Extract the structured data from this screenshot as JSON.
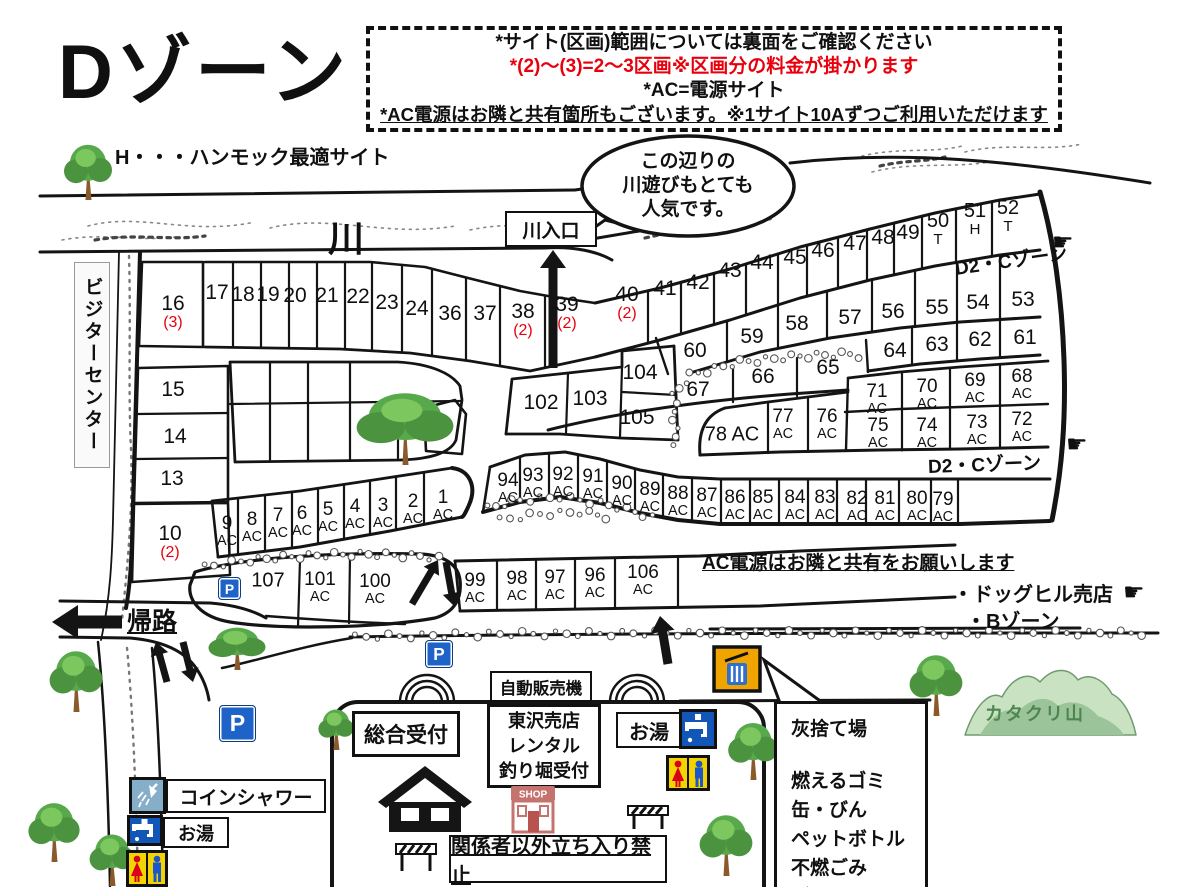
{
  "title": "Dゾーン",
  "notes": {
    "line1": "*サイト(区画)範囲については裏面をご確認ください",
    "line2": "*(2)〜(3)=2〜3区画※区画分の料金が掛かります",
    "line3": "*AC=電源サイト",
    "line4": "*AC電源はお隣と共有箇所もございます。※1サイト10Aずつご利用いただけます"
  },
  "legend": {
    "hammock": "H・・・ハンモック最適サイト"
  },
  "river": {
    "label": "川",
    "entrance": "川入口"
  },
  "bubble": {
    "line1": "この辺りの",
    "line2": "川遊びもとても",
    "line3": "人気です。"
  },
  "visitor_center": "ビジターセンター",
  "labels": {
    "kiro": "帰路",
    "ac_note": "AC電源はお隣と共有をお願いします",
    "doghill": "・ドッグヒル売店",
    "bzone": "・Bゾーン",
    "d2c": "D2・Cゾーン",
    "restricted": "関係者以外立ち入り禁止"
  },
  "facilities": {
    "vending": "自動販売機",
    "reception": "総合受付",
    "east_shop": [
      "東沢売店",
      "レンタル",
      "釣り堀受付"
    ],
    "hot_water": "お湯",
    "coin_shower": "コインシャワー",
    "shop_sign": "SHOP",
    "parking": "P"
  },
  "ash": {
    "title": "灰捨て場",
    "items": [
      "燃えるゴミ",
      "缶・びん",
      "ペットボトル",
      "不燃ごみ",
      "ダンボール"
    ]
  },
  "mountain": "カタクリ山",
  "icons": {
    "finger": "☛"
  },
  "colors": {
    "red": "#e8000d",
    "line": "#141414",
    "parking_blue": "#1e63c8",
    "toilet_yellow": "#f4d400",
    "faucet_blue": "#1257b8",
    "shower_blue": "#85aec9",
    "bin_orange": "#f0a400",
    "bin_blue": "#2f6fd0",
    "mountain_green": "#9cc49a",
    "tree_green": "#58a94b"
  },
  "d2c_instances": [
    {
      "x": 955,
      "y": 254,
      "rot": -8,
      "fx": 1052,
      "fy": 228
    },
    {
      "x": 928,
      "y": 452,
      "rot": -2,
      "fx": 1066,
      "fy": 430
    }
  ],
  "sites": [
    {
      "n": "16",
      "sub": "(3)",
      "red": true,
      "x": 173,
      "y": 312
    },
    {
      "n": "15",
      "x": 173,
      "y": 390
    },
    {
      "n": "14",
      "x": 175,
      "y": 437
    },
    {
      "n": "13",
      "x": 172,
      "y": 479
    },
    {
      "n": "10",
      "sub": "(2)",
      "red": true,
      "x": 170,
      "y": 542
    },
    {
      "n": "17",
      "x": 217,
      "y": 293
    },
    {
      "n": "18",
      "x": 243,
      "y": 295
    },
    {
      "n": "19",
      "x": 268,
      "y": 295
    },
    {
      "n": "20",
      "x": 295,
      "y": 296
    },
    {
      "n": "21",
      "x": 327,
      "y": 296
    },
    {
      "n": "22",
      "x": 358,
      "y": 297
    },
    {
      "n": "23",
      "x": 387,
      "y": 303
    },
    {
      "n": "24",
      "x": 417,
      "y": 309
    },
    {
      "n": "36",
      "x": 450,
      "y": 314
    },
    {
      "n": "37",
      "x": 485,
      "y": 314
    },
    {
      "n": "38",
      "sub": "(2)",
      "red": true,
      "x": 523,
      "y": 320
    },
    {
      "n": "39",
      "sub": "(2)",
      "red": true,
      "x": 567,
      "y": 313
    },
    {
      "n": "40",
      "sub": "(2)",
      "red": true,
      "x": 627,
      "y": 303
    },
    {
      "n": "41",
      "x": 665,
      "y": 289
    },
    {
      "n": "42",
      "x": 698,
      "y": 283
    },
    {
      "n": "43",
      "x": 730,
      "y": 271
    },
    {
      "n": "44",
      "x": 762,
      "y": 263
    },
    {
      "n": "45",
      "x": 795,
      "y": 258
    },
    {
      "n": "46",
      "x": 823,
      "y": 251
    },
    {
      "n": "47",
      "x": 855,
      "y": 244
    },
    {
      "n": "48",
      "x": 883,
      "y": 238
    },
    {
      "n": "49",
      "x": 908,
      "y": 233
    },
    {
      "n": "50",
      "sub": "T",
      "x": 938,
      "y": 229,
      "fs": 20
    },
    {
      "n": "51",
      "sub": "H",
      "x": 975,
      "y": 219,
      "fs": 20
    },
    {
      "n": "52",
      "sub": "T",
      "x": 1008,
      "y": 216,
      "fs": 20
    },
    {
      "n": "59",
      "x": 752,
      "y": 337
    },
    {
      "n": "58",
      "x": 797,
      "y": 324
    },
    {
      "n": "57",
      "x": 850,
      "y": 318
    },
    {
      "n": "56",
      "x": 893,
      "y": 312
    },
    {
      "n": "55",
      "x": 937,
      "y": 308
    },
    {
      "n": "54",
      "x": 978,
      "y": 303
    },
    {
      "n": "53",
      "x": 1023,
      "y": 300
    },
    {
      "n": "60",
      "x": 695,
      "y": 351
    },
    {
      "n": "64",
      "x": 895,
      "y": 351
    },
    {
      "n": "63",
      "x": 937,
      "y": 345
    },
    {
      "n": "62",
      "x": 980,
      "y": 340
    },
    {
      "n": "61",
      "x": 1025,
      "y": 338
    },
    {
      "n": "104",
      "x": 640,
      "y": 373
    },
    {
      "n": "102",
      "x": 541,
      "y": 403
    },
    {
      "n": "103",
      "x": 590,
      "y": 399
    },
    {
      "n": "105",
      "x": 637,
      "y": 418
    },
    {
      "n": "67",
      "x": 698,
      "y": 390
    },
    {
      "n": "66",
      "x": 763,
      "y": 377
    },
    {
      "n": "65",
      "x": 828,
      "y": 368
    },
    {
      "n": "71",
      "sub": "AC",
      "x": 877,
      "y": 399,
      "fs": 19
    },
    {
      "n": "70",
      "sub": "AC",
      "x": 927,
      "y": 394,
      "fs": 19
    },
    {
      "n": "69",
      "sub": "AC",
      "x": 975,
      "y": 388,
      "fs": 19
    },
    {
      "n": "68",
      "sub": "AC",
      "x": 1022,
      "y": 384,
      "fs": 19
    },
    {
      "n": "75",
      "sub": "AC",
      "x": 878,
      "y": 433,
      "fs": 19
    },
    {
      "n": "74",
      "sub": "AC",
      "x": 927,
      "y": 433,
      "fs": 19
    },
    {
      "n": "73",
      "sub": "AC",
      "x": 977,
      "y": 430,
      "fs": 19
    },
    {
      "n": "72",
      "sub": "AC",
      "x": 1022,
      "y": 427,
      "fs": 19
    },
    {
      "n": "77",
      "sub": "AC",
      "x": 783,
      "y": 424,
      "fs": 19
    },
    {
      "n": "76",
      "sub": "AC",
      "x": 827,
      "y": 424,
      "fs": 19
    },
    {
      "n": "78 AC",
      "x": 732,
      "y": 435,
      "fs": 20
    },
    {
      "n": "94",
      "sub": "AC",
      "x": 508,
      "y": 488,
      "fs": 19
    },
    {
      "n": "93",
      "sub": "AC",
      "x": 533,
      "y": 483,
      "fs": 19
    },
    {
      "n": "92",
      "sub": "AC",
      "x": 563,
      "y": 482,
      "fs": 19
    },
    {
      "n": "91",
      "sub": "AC",
      "x": 593,
      "y": 484,
      "fs": 19
    },
    {
      "n": "90",
      "sub": "AC",
      "x": 622,
      "y": 491,
      "fs": 19
    },
    {
      "n": "89",
      "sub": "AC",
      "x": 650,
      "y": 497,
      "fs": 19
    },
    {
      "n": "88",
      "sub": "AC",
      "x": 678,
      "y": 501,
      "fs": 19
    },
    {
      "n": "87",
      "sub": "AC",
      "x": 707,
      "y": 503,
      "fs": 19
    },
    {
      "n": "86",
      "sub": "AC",
      "x": 735,
      "y": 505,
      "fs": 19
    },
    {
      "n": "85",
      "sub": "AC",
      "x": 763,
      "y": 505,
      "fs": 19
    },
    {
      "n": "84",
      "sub": "AC",
      "x": 795,
      "y": 505,
      "fs": 19
    },
    {
      "n": "83",
      "sub": "AC",
      "x": 825,
      "y": 505,
      "fs": 19
    },
    {
      "n": "82",
      "sub": "AC",
      "x": 857,
      "y": 506,
      "fs": 19
    },
    {
      "n": "81",
      "sub": "AC",
      "x": 885,
      "y": 506,
      "fs": 19
    },
    {
      "n": "80",
      "sub": "AC",
      "x": 917,
      "y": 506,
      "fs": 19
    },
    {
      "n": "79",
      "sub": "AC",
      "x": 943,
      "y": 507,
      "fs": 19
    },
    {
      "n": "9",
      "sub": "AC",
      "x": 227,
      "y": 531,
      "fs": 19
    },
    {
      "n": "8",
      "sub": "AC",
      "x": 252,
      "y": 527,
      "fs": 19
    },
    {
      "n": "7",
      "sub": "AC",
      "x": 278,
      "y": 523,
      "fs": 19
    },
    {
      "n": "6",
      "sub": "AC",
      "x": 302,
      "y": 521,
      "fs": 19
    },
    {
      "n": "5",
      "sub": "AC",
      "x": 328,
      "y": 517,
      "fs": 19
    },
    {
      "n": "4",
      "sub": "AC",
      "x": 355,
      "y": 514,
      "fs": 19
    },
    {
      "n": "3",
      "sub": "AC",
      "x": 383,
      "y": 513,
      "fs": 19
    },
    {
      "n": "2",
      "sub": "AC",
      "x": 413,
      "y": 509,
      "fs": 19
    },
    {
      "n": "1",
      "sub": "AC",
      "x": 443,
      "y": 505,
      "fs": 19
    },
    {
      "n": "107",
      "x": 268,
      "y": 581,
      "fs": 20
    },
    {
      "n": "101",
      "sub": "AC",
      "x": 320,
      "y": 587,
      "fs": 19
    },
    {
      "n": "100",
      "sub": "AC",
      "x": 375,
      "y": 589,
      "fs": 19
    },
    {
      "n": "99",
      "sub": "AC",
      "x": 475,
      "y": 588,
      "fs": 19
    },
    {
      "n": "98",
      "sub": "AC",
      "x": 517,
      "y": 586,
      "fs": 19
    },
    {
      "n": "97",
      "sub": "AC",
      "x": 555,
      "y": 585,
      "fs": 19
    },
    {
      "n": "96",
      "sub": "AC",
      "x": 595,
      "y": 583,
      "fs": 19
    },
    {
      "n": "106",
      "sub": "AC",
      "x": 643,
      "y": 580,
      "fs": 19
    }
  ],
  "decor": {
    "trees": [
      {
        "x": 88,
        "y": 200,
        "s": 60
      },
      {
        "x": 405,
        "y": 465,
        "s": 78,
        "b": 1
      },
      {
        "x": 237,
        "y": 670,
        "s": 46,
        "b": 1
      },
      {
        "x": 76,
        "y": 712,
        "s": 66
      },
      {
        "x": 54,
        "y": 862,
        "s": 64
      },
      {
        "x": 112,
        "y": 886,
        "s": 56
      },
      {
        "x": 336,
        "y": 750,
        "s": 44
      },
      {
        "x": 753,
        "y": 780,
        "s": 62
      },
      {
        "x": 936,
        "y": 716,
        "s": 66
      },
      {
        "x": 726,
        "y": 876,
        "s": 66
      }
    ],
    "parkings": [
      {
        "x": 218,
        "y": 577,
        "s": 21
      },
      {
        "x": 425,
        "y": 640,
        "s": 26
      },
      {
        "x": 219,
        "y": 705,
        "s": 35
      }
    ]
  }
}
